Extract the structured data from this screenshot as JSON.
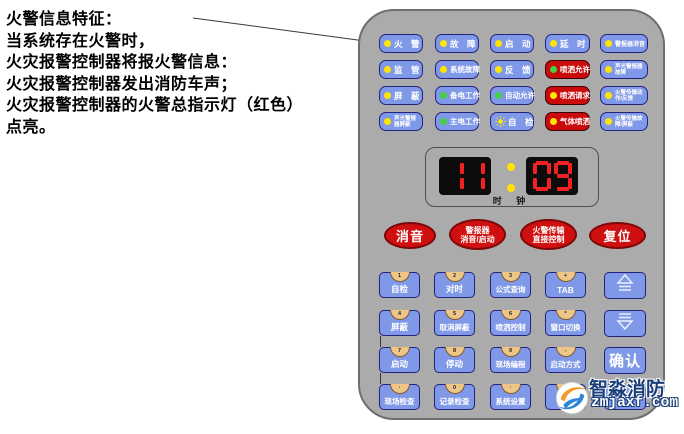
{
  "annotation": {
    "lines": [
      "火警信息特征：",
      "当系统存在火警时，",
      "火灾报警控制器将报火警信息：",
      "火灾报警控制器发出消防车声；",
      "火灾报警控制器的火警总指示灯（红色）",
      "点亮。"
    ]
  },
  "panel": {
    "indicators": {
      "rows": [
        [
          {
            "name": "fire-alarm",
            "label": "火　警",
            "led": "yellow",
            "style": "blue"
          },
          {
            "name": "fault",
            "label": "故　障",
            "led": "yellow",
            "style": "blue"
          },
          {
            "name": "start",
            "label": "启　动",
            "led": "yellow",
            "style": "blue"
          },
          {
            "name": "delay",
            "label": "延　时",
            "led": "yellow",
            "style": "blue"
          },
          {
            "name": "sounder-mute",
            "label": "警报器消音",
            "led": "yellow",
            "style": "blue",
            "small": true
          }
        ],
        [
          {
            "name": "supervisory",
            "label": "监　管",
            "led": "yellow",
            "style": "blue"
          },
          {
            "name": "system-fault",
            "label": "系统故障",
            "led": "yellow",
            "style": "blue"
          },
          {
            "name": "feedback",
            "label": "反　馈",
            "led": "yellow",
            "style": "blue"
          },
          {
            "name": "spray-allowed",
            "label": "喷洒允许",
            "led": "green",
            "style": "red"
          },
          {
            "name": "sounder-fault",
            "lines": [
              "声光警报器",
              "故障"
            ],
            "led": "yellow",
            "style": "blue"
          }
        ],
        [
          {
            "name": "shield",
            "label": "屏　蔽",
            "led": "yellow",
            "style": "blue"
          },
          {
            "name": "backup-power",
            "label": "备电工作",
            "led": "green",
            "style": "blue"
          },
          {
            "name": "auto-allowed",
            "label": "自动允许",
            "led": "green",
            "style": "blue"
          },
          {
            "name": "spray-request",
            "label": "喷洒请求",
            "led": "yellow",
            "style": "red"
          },
          {
            "name": "fire-transmission-action",
            "lines": [
              "火警传输动",
              "作/反馈"
            ],
            "led": "yellow",
            "style": "blue"
          }
        ],
        [
          {
            "name": "sounder-shield",
            "lines": [
              "声光警报",
              "器屏蔽"
            ],
            "led": "yellow",
            "style": "blue"
          },
          {
            "name": "main-power",
            "label": "主电工作",
            "led": "green",
            "style": "blue"
          },
          {
            "name": "self-test-lamp",
            "label": "自　检",
            "led": "sun",
            "style": "blue"
          },
          {
            "name": "gas-spray",
            "label": "气体喷洒",
            "led": "yellow",
            "style": "red"
          },
          {
            "name": "fire-transmission-fault",
            "lines": [
              "火警传输故",
              "障/屏蔽"
            ],
            "led": "yellow",
            "style": "blue"
          }
        ]
      ]
    },
    "clock": {
      "hours": "11",
      "minutes": "09",
      "label": "时 钟"
    },
    "oval_buttons": [
      {
        "name": "mute",
        "lines": [
          "消音"
        ]
      },
      {
        "name": "sounder-mute-start",
        "lines": [
          "警报器",
          "消音/启动"
        ]
      },
      {
        "name": "fire-transmission-direct-control",
        "lines": [
          "火警传输",
          "直接控制"
        ]
      },
      {
        "name": "reset",
        "lines": [
          "复位"
        ]
      }
    ],
    "keypad": {
      "rows": [
        [
          {
            "name": "self-test",
            "label": "自检",
            "key": "1"
          },
          {
            "name": "time-set",
            "label": "对时",
            "key": "2"
          },
          {
            "name": "formula-query",
            "label": "公式查询",
            "key": "3"
          },
          {
            "name": "tab",
            "label": "TAB",
            "key": "+"
          }
        ],
        [
          {
            "name": "shield-key",
            "label": "屏蔽",
            "key": "4"
          },
          {
            "name": "unshield",
            "label": "取消屏蔽",
            "key": "5"
          },
          {
            "name": "spray-control",
            "label": "喷洒控制",
            "key": "6"
          },
          {
            "name": "window-switch",
            "label": "窗口切换",
            "key": "*"
          }
        ],
        [
          {
            "name": "start-key",
            "label": "启动",
            "key": "7"
          },
          {
            "name": "stop-key",
            "label": "停动",
            "key": "8"
          },
          {
            "name": "field-program",
            "label": "现场编程",
            "key": "9"
          },
          {
            "name": "start-mode",
            "label": "启动方式",
            "key": "-"
          }
        ],
        [
          {
            "name": "field-check",
            "label": "现场检查",
            "key": "·"
          },
          {
            "name": "record-check",
            "label": "记录检查",
            "key": "0"
          },
          {
            "name": "system-setup",
            "label": "系统设置",
            "key": "·"
          },
          {
            "name": "print",
            "label": "打印",
            "key": ""
          }
        ]
      ],
      "confirm_label": "确认"
    },
    "logo": {
      "brand": "智淼消防",
      "site": "zmjaxf.com"
    }
  },
  "colors": {
    "panel_gray": "#ababab",
    "button_blue": "#8098e8",
    "button_red": "#c90b0b",
    "oval_red": "#d01010",
    "led_yellow": "#ffe400",
    "led_green": "#44d044",
    "digit_red": "#f22020"
  }
}
